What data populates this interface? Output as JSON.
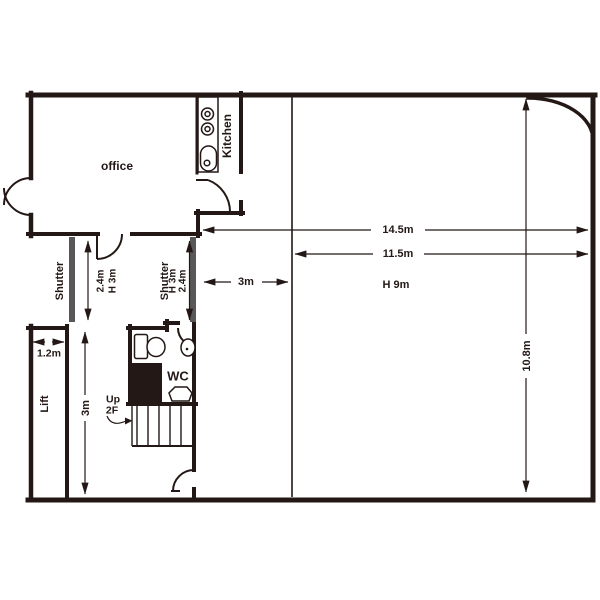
{
  "plan": {
    "background": "#ffffff",
    "wall_color": "#231815",
    "shutter_color": "#595757",
    "labels": {
      "office": "office",
      "kitchen": "Kitchen",
      "shutter_left": "Shutter",
      "shutter_right": "Shutter",
      "lift": "Lift",
      "wc": "WC",
      "stairs_up": "Up",
      "stairs_floor": "2F"
    },
    "dimensions": {
      "overall_width": "14.5m",
      "main_room_width": "11.5m",
      "ceiling_height": "H 9m",
      "main_room_depth": "10.8m",
      "corridor_width": "3m",
      "shutter_left_width": "2.4m",
      "shutter_left_height": "H 3m",
      "shutter_right_height": "H 3m",
      "shutter_right_width": "2.4m",
      "lift_width": "1.2m",
      "lift_area_depth": "3m"
    }
  }
}
